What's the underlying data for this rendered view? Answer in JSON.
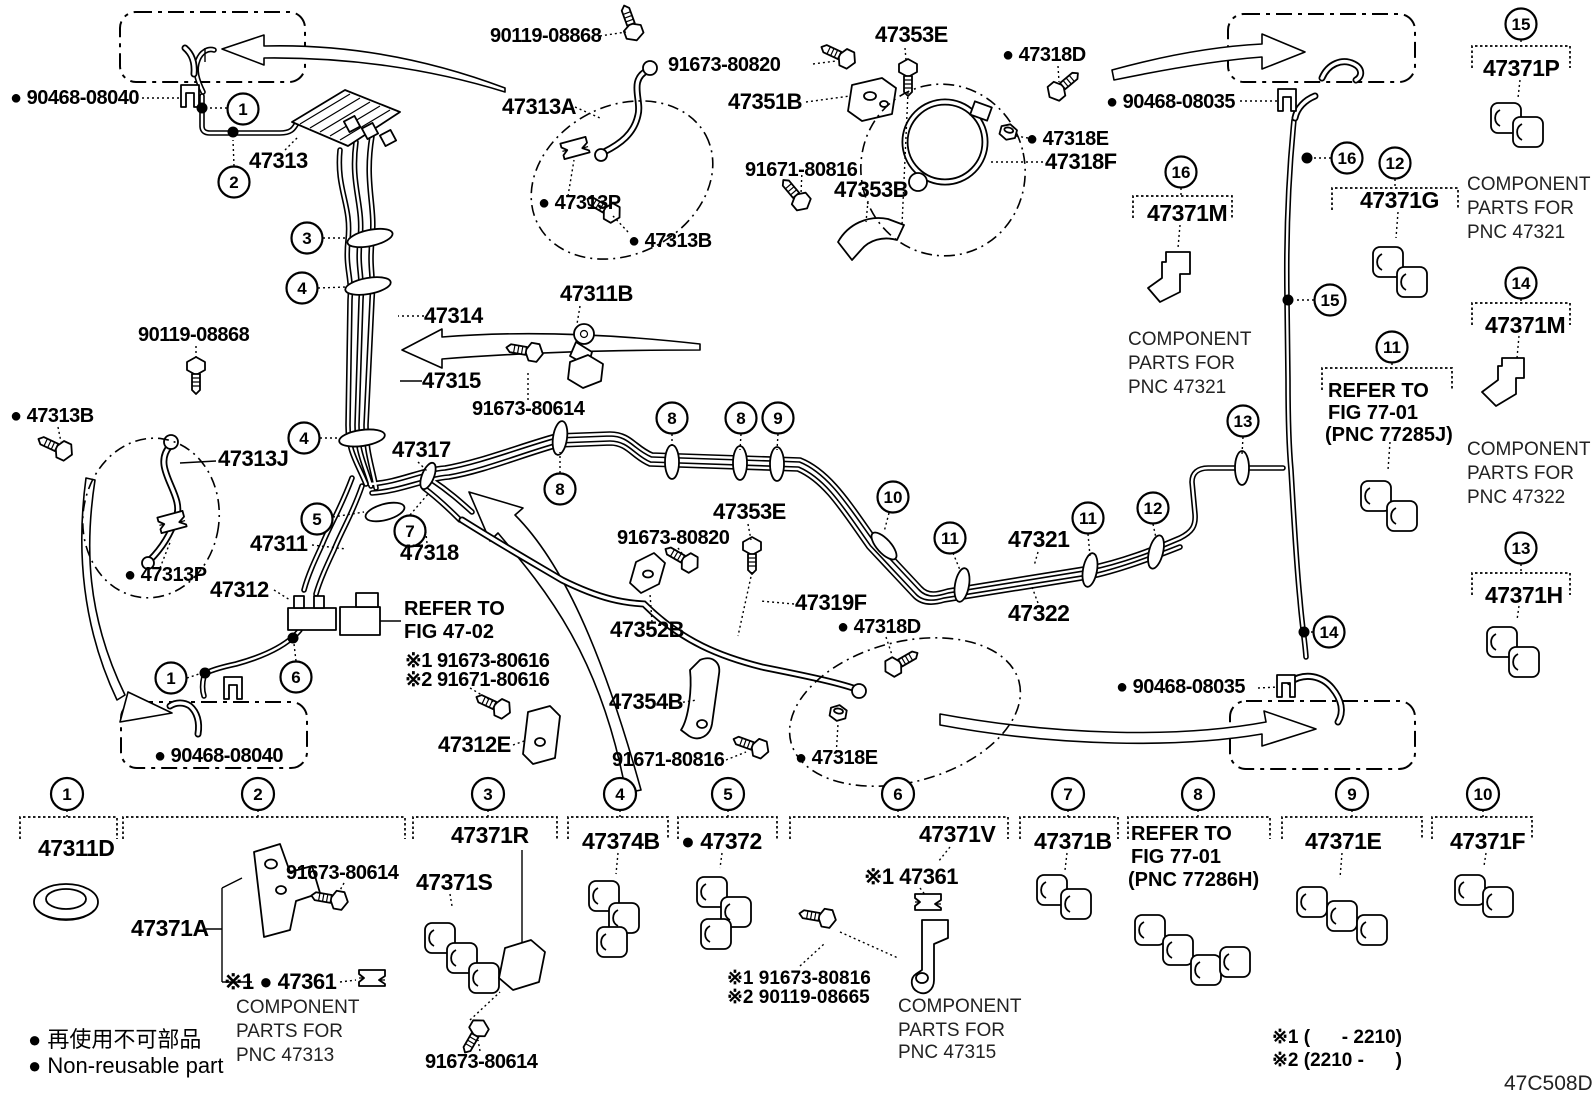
{
  "diagram_code": "47C508D",
  "legend": {
    "jp": "● 再使用不可部品",
    "en": "● Non-reusable part"
  },
  "footnotes": {
    "n1": "※1 (      - 2210)",
    "n2": "※2 (2210 -      )"
  },
  "callouts": {
    "c1": "1",
    "c2": "2",
    "c3": "3",
    "c4": "4",
    "c5": "5",
    "c6": "6",
    "c7": "7",
    "c8": "8",
    "c9": "9",
    "c10": "10",
    "c11": "11",
    "c12": "12",
    "c13": "13",
    "c14": "14",
    "c15": "15",
    "c16": "16"
  },
  "parts": {
    "p90468_08040": "● 90468-08040",
    "p90468_08035": "● 90468-08035",
    "p90119_08868": "90119-08868",
    "p91673_80820": "91673-80820",
    "p91671_80816": "91671-80816",
    "p91673_80614": "91673-80614",
    "p47313": "47313",
    "p47313A": "47313A",
    "p47313B": "● 47313B",
    "p47313P": "● 47313P",
    "p47313J": "47313J",
    "p47351B": "47351B",
    "p47353E": "47353E",
    "p47353B": "47353B",
    "p47318D": "● 47318D",
    "p47318E": "● 47318E",
    "p47318F": "47318F",
    "p47314": "47314",
    "p47315": "47315",
    "p47311": "47311",
    "p47311B": "47311B",
    "p47312": "47312",
    "p47312E": "47312E",
    "p47317": "47317",
    "p47318": "47318",
    "p47319F": "47319F",
    "p47352B": "47352B",
    "p47354B": "47354B",
    "p47321": "47321",
    "p47322": "47322",
    "p47311D": "47311D",
    "p47371A": "47371A",
    "p47371R": "47371R",
    "p47371S": "47371S",
    "p47374B": "47374B",
    "p47372": "● 47372",
    "p47371V": "47371V",
    "p47371B": "47371B",
    "p47371E": "47371E",
    "p47371F": "47371F",
    "p47371M": "47371M",
    "p47371G": "47371G",
    "p47371P": "47371P",
    "p47371H": "47371H",
    "n1_91673_80616": "※1 91673-80616",
    "n2_91671_80616": "※2 91671-80616",
    "n1_47361_dot": "※1 ● 47361",
    "n1_47361": "※1 47361",
    "n1_91673_80816": "※1 91673-80816",
    "n2_90119_08665": "※2 90119-08665"
  },
  "component_notes": {
    "pnc47321": [
      "COMPONENT",
      "PARTS FOR",
      "PNC 47321"
    ],
    "pnc47322": [
      "COMPONENT",
      "PARTS FOR",
      "PNC 47322"
    ],
    "pnc47313": [
      "COMPONENT",
      "PARTS FOR",
      "PNC 47313"
    ],
    "pnc47315": [
      "COMPONENT",
      "PARTS FOR",
      "PNC 47315"
    ]
  },
  "refer": {
    "fig4702": [
      "REFER TO",
      "FIG 47-02"
    ],
    "fig7701a": [
      "REFER TO",
      "FIG 77-01",
      "(PNC 77285J)"
    ],
    "fig7701b": [
      "REFER TO",
      "FIG 77-01",
      "(PNC 77286H)"
    ]
  }
}
